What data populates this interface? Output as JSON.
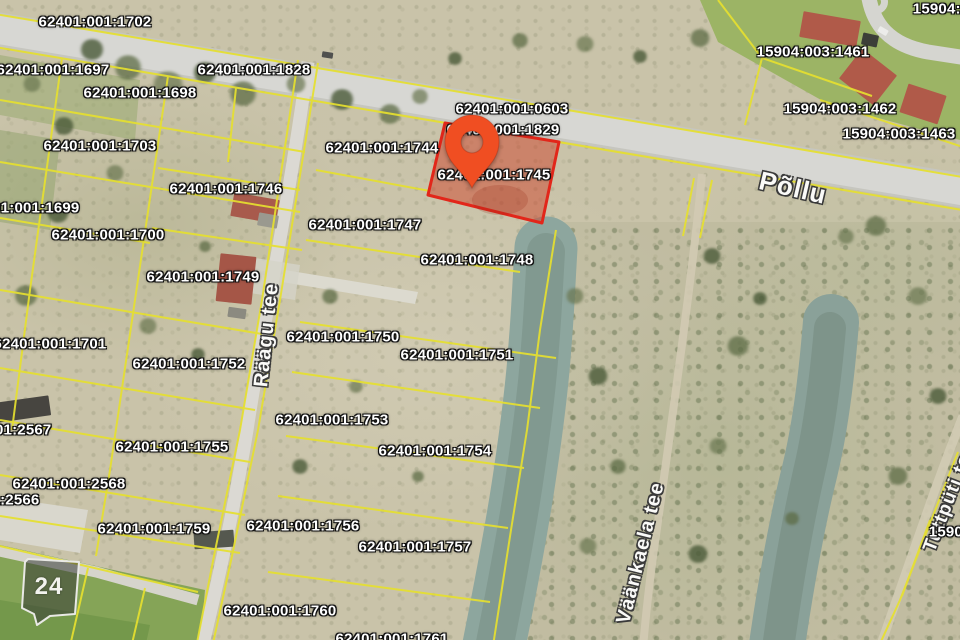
{
  "map": {
    "highlighted_parcel": {
      "code": "62401:001:1745"
    },
    "marker_badge": {
      "text": "24"
    },
    "parcel_labels": [
      {
        "code": "62401:001:1702",
        "x": 95,
        "y": 22
      },
      {
        "code": "62401:001:1697",
        "x": 53,
        "y": 70
      },
      {
        "code": "62401:001:1698",
        "x": 140,
        "y": 93
      },
      {
        "code": "62401:001:1828",
        "x": 254,
        "y": 70
      },
      {
        "code": "62401:001:1703",
        "x": 100,
        "y": 146
      },
      {
        "code": "62401:001:1746",
        "x": 226,
        "y": 189
      },
      {
        "code": "62401:001:1699",
        "x": 23,
        "y": 208
      },
      {
        "code": "62401:001:1700",
        "x": 108,
        "y": 235
      },
      {
        "code": "62401:001:1749",
        "x": 203,
        "y": 277
      },
      {
        "code": "62401:001:1701",
        "x": 50,
        "y": 344
      },
      {
        "code": "62401:001:1752",
        "x": 189,
        "y": 364
      },
      {
        "code": "62401:001:1744",
        "x": 382,
        "y": 148
      },
      {
        "code": "62401:001:0603",
        "x": 512,
        "y": 109
      },
      {
        "code": "62401:001:1829",
        "x": 503,
        "y": 130
      },
      {
        "code": "62401:001:1745",
        "x": 494,
        "y": 175
      },
      {
        "code": "62401:001:1747",
        "x": 365,
        "y": 225
      },
      {
        "code": "62401:001:1748",
        "x": 477,
        "y": 260
      },
      {
        "code": "62401:001:1750",
        "x": 343,
        "y": 337
      },
      {
        "code": "62401:001:1751",
        "x": 457,
        "y": 355
      },
      {
        "code": "62401:001:1753",
        "x": 332,
        "y": 420
      },
      {
        "code": "62401:001:1754",
        "x": 435,
        "y": 451
      },
      {
        "code": "62401:001:1755",
        "x": 172,
        "y": 447
      },
      {
        "code": "62401:001:2567",
        "x": -5,
        "y": 430
      },
      {
        "code": "62401:001:2568",
        "x": 69,
        "y": 484
      },
      {
        "code": "62401:001:2566",
        "x": -17,
        "y": 500
      },
      {
        "code": "62401:001:1759",
        "x": 154,
        "y": 529
      },
      {
        "code": "62401:001:1756",
        "x": 303,
        "y": 526
      },
      {
        "code": "62401:001:1757",
        "x": 415,
        "y": 547
      },
      {
        "code": "62401:001:1760",
        "x": 280,
        "y": 611
      },
      {
        "code": "62401:001:1761",
        "x": 392,
        "y": 639
      },
      {
        "code": "15904:003:1461",
        "x": 813,
        "y": 52
      },
      {
        "code": "15904:003:1462",
        "x": 840,
        "y": 109
      },
      {
        "code": "15904:003:1463",
        "x": 899,
        "y": 134
      },
      {
        "code": "15904:0",
        "x": 941,
        "y": 9
      },
      {
        "code": "15904:0",
        "x": 957,
        "y": 532
      }
    ],
    "street_labels": [
      {
        "name": "Põllu",
        "x": 793,
        "y": 188,
        "rot": 13,
        "size": 26
      },
      {
        "name": "Räägu tee",
        "x": 267,
        "y": 335,
        "rot": -84,
        "size": 20
      },
      {
        "name": "Väänkaela tee",
        "x": 641,
        "y": 553,
        "rot": -76,
        "size": 20
      },
      {
        "name": "Tuttpüti tee",
        "x": 950,
        "y": 498,
        "rot": -69,
        "size": 19
      }
    ],
    "colors": {
      "boundary_line": "#e6e02f",
      "highlight_fill": "rgba(206,72,48,0.52)",
      "highlight_border": "#e2261a",
      "pin": "#f04e22",
      "water": "#8da69e",
      "pond": "#8aa199",
      "road": "#d7d7d3"
    }
  }
}
